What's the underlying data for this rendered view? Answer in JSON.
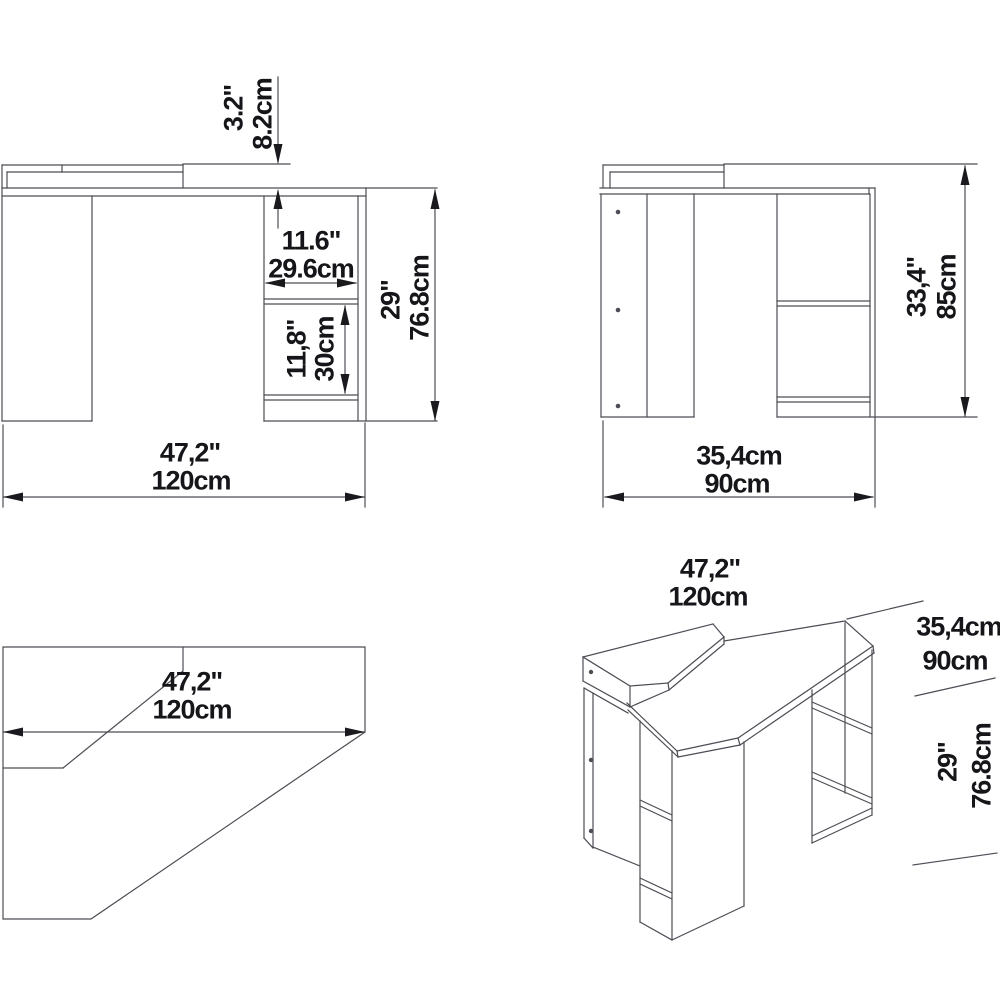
{
  "page": {
    "background": "#ffffff",
    "line_color": "#4d4d55",
    "arrow_color": "#1a1a1e",
    "text_color": "#16161a",
    "drawing_type": "corner-desk dimension drawing"
  },
  "views": {
    "front": {
      "riser_height_in": "3.2\"",
      "riser_height_cm": "8.2cm",
      "compartment_width_in": "11.6\"",
      "compartment_width_cm": "29.6cm",
      "compartment_height_in": "11,8\"",
      "compartment_height_cm": "30cm",
      "overall_height_in": "29\"",
      "overall_height_cm": "76.8cm",
      "overall_width_in": "47,2\"",
      "overall_width_cm": "120cm"
    },
    "side": {
      "overall_height_in": "33,4\"",
      "overall_height_cm": "85cm",
      "depth_label_top": "35,4cm",
      "depth_label_bottom": "90cm"
    },
    "top": {
      "overall_width_in": "47,2\"",
      "overall_width_cm": "120cm"
    },
    "iso": {
      "overall_width_in": "47,2\"",
      "overall_width_cm": "120cm",
      "depth_label_top": "35,4cm",
      "depth_label_bottom": "90cm",
      "overall_height_in": "29\"",
      "overall_height_cm": "76.8cm"
    }
  }
}
